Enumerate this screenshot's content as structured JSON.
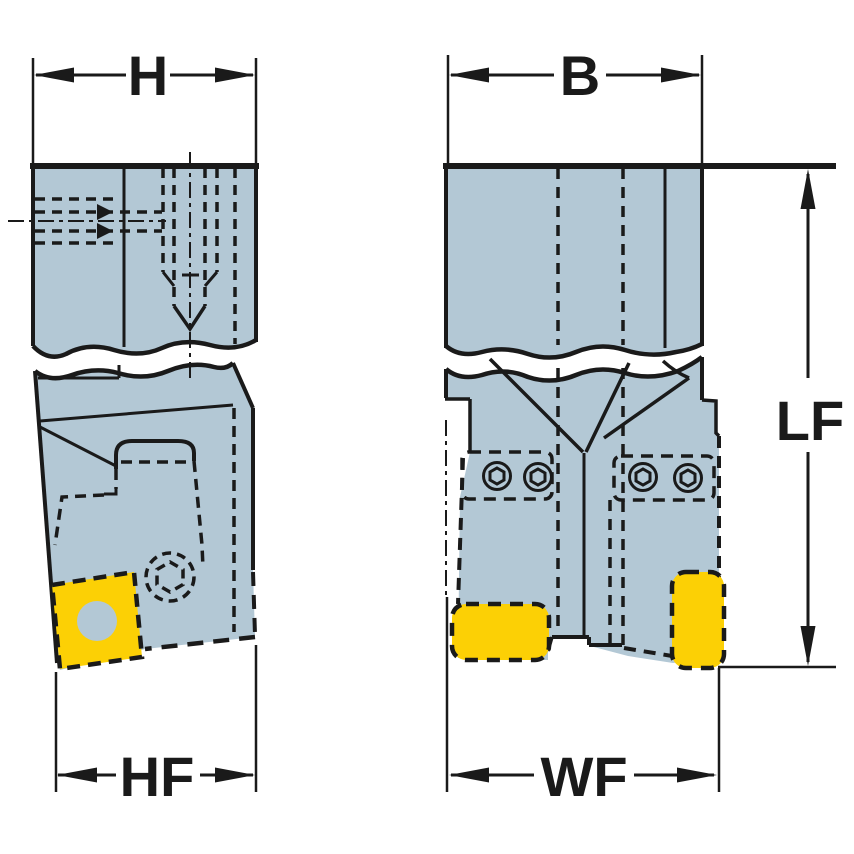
{
  "drawing": {
    "type": "tool-holder-dimension-drawing",
    "labels": {
      "h": "H",
      "b": "B",
      "lf": "LF",
      "hf": "HF",
      "wf": "WF"
    }
  },
  "colors": {
    "body": "#b3c8d5",
    "insert": "#fcd005",
    "line": "#1a1a1a",
    "background": "#ffffff"
  }
}
